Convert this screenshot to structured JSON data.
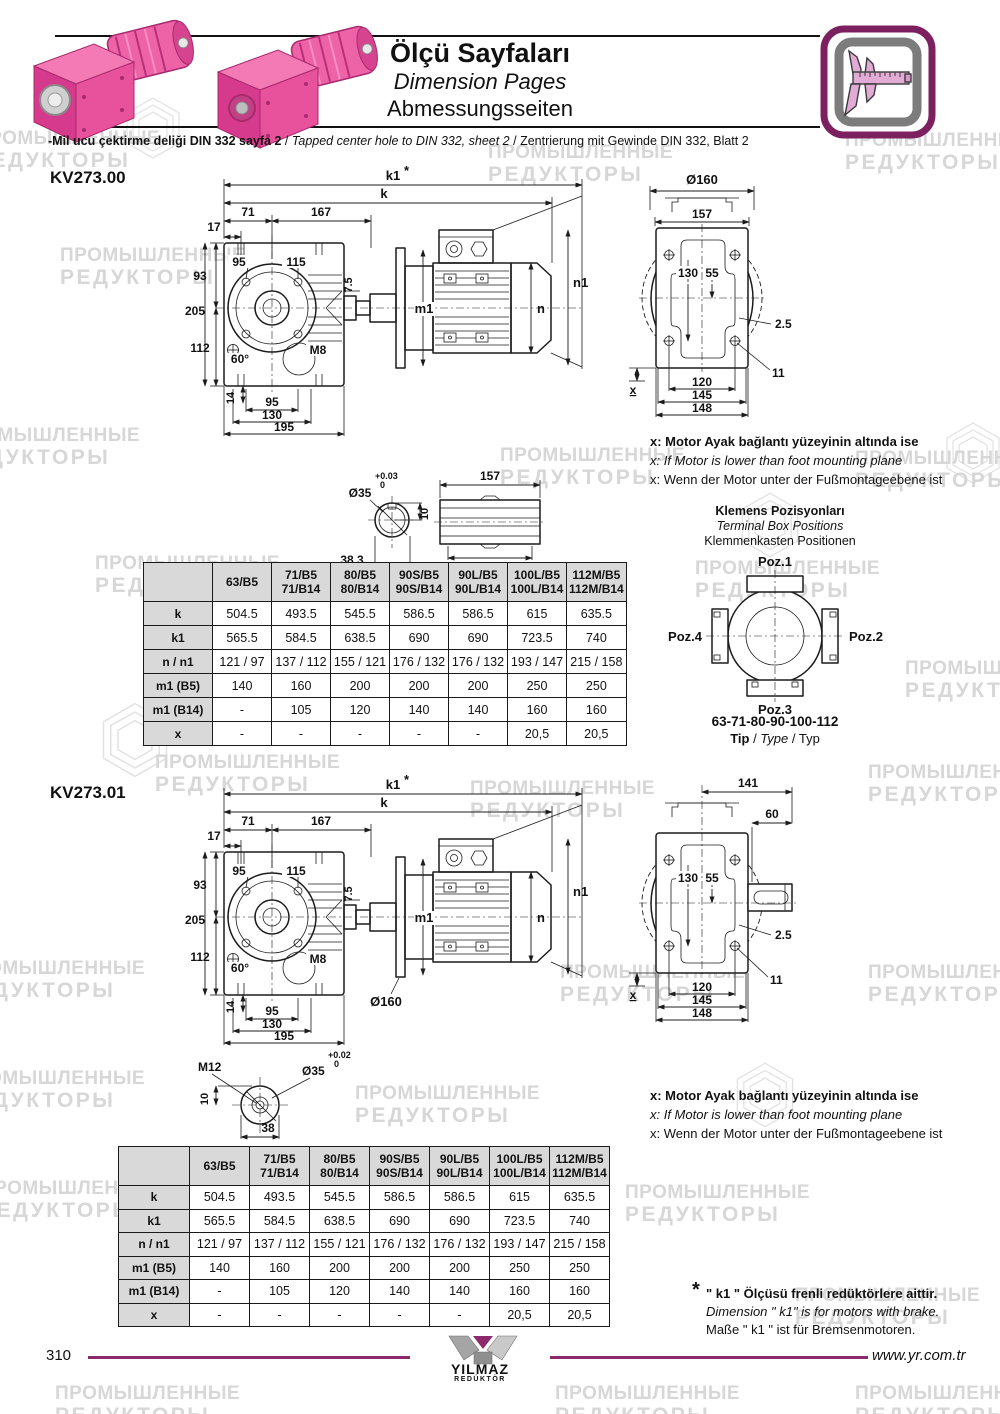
{
  "page": {
    "number": "310",
    "website": "www.yr.com.tr"
  },
  "watermark": {
    "line1": "ПРОМЫШЛЕННЫЕ",
    "line2": "РЕДУКТОРЫ"
  },
  "colors": {
    "accent_pink": "#e0449a",
    "brand_purple": "#7d2060",
    "footer_line": "#8b2a6b",
    "table_header_bg": "#d9d9d9",
    "watermark_gray": "#d7d7d7"
  },
  "header": {
    "title_tr": "Ölçü Sayfaları",
    "title_en": "Dimension Pages",
    "title_de": "Abmessungsseiten",
    "note_tr": "-Mil ucu çektirme deliği DIN 332 sayfa 2",
    "note_sep1": "/",
    "note_en": "Tapped center hole to DIN 332, sheet 2",
    "note_sep2": "/",
    "note_de": "Zentrierung mit Gewinde DIN 332, Blatt 2"
  },
  "motor_note": {
    "tr": "x: Motor Ayak bağlantı yüzeyinin altında ise",
    "en": "x: If Motor is lower than foot mounting plane",
    "de": "x: Wenn der Motor unter der Fußmontageebene ist"
  },
  "terminal_box": {
    "title_tr": "Klemens Pozisyonları",
    "title_en": "Terminal Box Positions",
    "title_de": "Klemmenkasten Positionen",
    "poz1": "Poz.1",
    "poz2": "Poz.2",
    "poz3": "Poz.3",
    "poz4": "Poz.4",
    "types": "63-71-80-90-100-112",
    "tip_tr": "Tip",
    "tip_sep1": " / ",
    "tip_en": "Type",
    "tip_sep2": " / ",
    "tip_de": "Typ"
  },
  "k1_note": {
    "star": "*",
    "tr": "\" k1 \" Ölçüsü frenli redüktörlere aittir.",
    "en": "Dimension \" k1\" is for motors with brake.",
    "de": "Maße \" k1 \" ist für Bremsenmotoren."
  },
  "logo": {
    "line1": "YILMAZ",
    "line2": "REDÜKTÖR"
  },
  "sections": [
    {
      "model": "KV273.00",
      "side": {
        "k1": "k1",
        "star": "*",
        "k": "k",
        "d71": "71",
        "d167": "167",
        "d17": "17",
        "d95_top": "95",
        "d115": "115",
        "d93": "93",
        "d205": "205",
        "d112": "112",
        "d60": "60°",
        "m8": "M8",
        "d7_5": "7.5",
        "m1": "m1",
        "n": "n",
        "n1": "n1",
        "d14": "14",
        "d95_bot": "95",
        "d130": "130",
        "d195": "195"
      },
      "rear": {
        "d160": "Ø160",
        "d157": "157",
        "d130": "130",
        "d55": "55",
        "d2_5": "2.5",
        "d11": "11",
        "d120": "120",
        "d145": "145",
        "d148": "148",
        "x": "x"
      },
      "shaft": {
        "dia": "Ø35",
        "tol_plus": "+0.03",
        "tol_zero": "0",
        "d10": "10",
        "d38_3": "38.3",
        "d157": "157",
        "d132": "132"
      },
      "table": {
        "columns": [
          [
            ""
          ],
          [
            "63/B5"
          ],
          [
            "71/B5",
            "71/B14"
          ],
          [
            "80/B5",
            "80/B14"
          ],
          [
            "90S/B5",
            "90S/B14"
          ],
          [
            "90L/B5",
            "90L/B14"
          ],
          [
            "100L/B5",
            "100L/B14"
          ],
          [
            "112M/B5",
            "112M/B14"
          ]
        ],
        "rows": [
          {
            "label": "k",
            "values": [
              "504.5",
              "493.5",
              "545.5",
              "586.5",
              "586.5",
              "615",
              "635.5"
            ]
          },
          {
            "label": "k1",
            "values": [
              "565.5",
              "584.5",
              "638.5",
              "690",
              "690",
              "723.5",
              "740"
            ]
          },
          {
            "label": "n / n1",
            "values": [
              "121 / 97",
              "137 / 112",
              "155 / 121",
              "176 / 132",
              "176 / 132",
              "193 / 147",
              "215 / 158"
            ]
          },
          {
            "label": "m1 (B5)",
            "values": [
              "140",
              "160",
              "200",
              "200",
              "200",
              "250",
              "250"
            ]
          },
          {
            "label": "m1 (B14)",
            "values": [
              "-",
              "105",
              "120",
              "140",
              "140",
              "160",
              "160"
            ]
          },
          {
            "label": "x",
            "values": [
              "-",
              "-",
              "-",
              "-",
              "-",
              "20,5",
              "20,5"
            ]
          }
        ]
      }
    },
    {
      "model": "KV273.01",
      "side": {
        "k1": "k1",
        "star": "*",
        "k": "k",
        "d71": "71",
        "d167": "167",
        "d17": "17",
        "d95_top": "95",
        "d115": "115",
        "d93": "93",
        "d205": "205",
        "d112": "112",
        "d60": "60°",
        "m8": "M8",
        "d7_5": "7.5",
        "m1": "m1",
        "n": "n",
        "n1": "n1",
        "d14": "14",
        "d95_bot": "95",
        "d130": "130",
        "d195": "195",
        "d160": "Ø160"
      },
      "rear": {
        "d141": "141",
        "d60": "60",
        "d130": "130",
        "d55": "55",
        "d2_5": "2.5",
        "d11": "11",
        "d120": "120",
        "d145": "145",
        "d148": "148",
        "x": "x"
      },
      "shaft": {
        "m12": "M12",
        "dia": "Ø35",
        "tol_plus": "+0.02",
        "tol_zero": "0",
        "d10": "10",
        "d38": "38"
      },
      "table": {
        "columns": [
          [
            ""
          ],
          [
            "63/B5"
          ],
          [
            "71/B5",
            "71/B14"
          ],
          [
            "80/B5",
            "80/B14"
          ],
          [
            "90S/B5",
            "90S/B14"
          ],
          [
            "90L/B5",
            "90L/B14"
          ],
          [
            "100L/B5",
            "100L/B14"
          ],
          [
            "112M/B5",
            "112M/B14"
          ]
        ],
        "rows": [
          {
            "label": "k",
            "values": [
              "504.5",
              "493.5",
              "545.5",
              "586.5",
              "586.5",
              "615",
              "635.5"
            ]
          },
          {
            "label": "k1",
            "values": [
              "565.5",
              "584.5",
              "638.5",
              "690",
              "690",
              "723.5",
              "740"
            ]
          },
          {
            "label": "n / n1",
            "values": [
              "121 / 97",
              "137 / 112",
              "155 / 121",
              "176 / 132",
              "176 / 132",
              "193 / 147",
              "215 / 158"
            ]
          },
          {
            "label": "m1 (B5)",
            "values": [
              "140",
              "160",
              "200",
              "200",
              "200",
              "250",
              "250"
            ]
          },
          {
            "label": "m1 (B14)",
            "values": [
              "-",
              "105",
              "120",
              "140",
              "140",
              "160",
              "160"
            ]
          },
          {
            "label": "x",
            "values": [
              "-",
              "-",
              "-",
              "-",
              "-",
              "20,5",
              "20,5"
            ]
          }
        ]
      }
    }
  ]
}
